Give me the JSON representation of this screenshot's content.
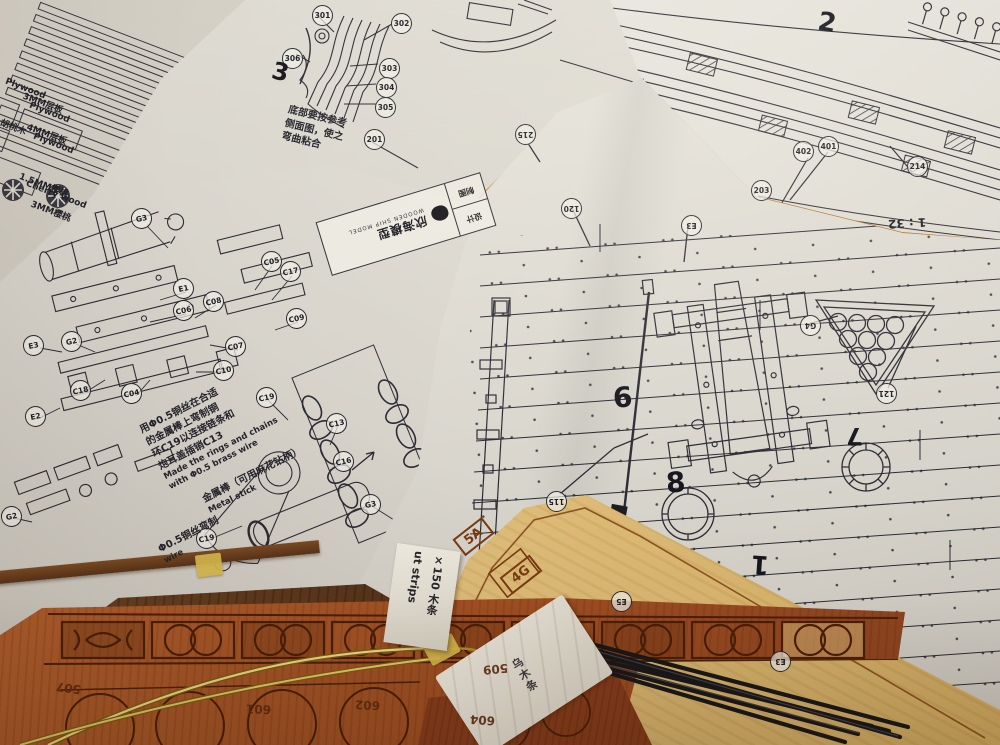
{
  "scene": {
    "scale_label": "1 : 32"
  },
  "title_block": {
    "brand": "欣海模型",
    "brand_sub": "WOODEN SHIP MODEL",
    "field_design": "设计",
    "field_draft": "制图"
  },
  "parts_sheet": {
    "labels": [
      {
        "t": "Plywood",
        "x": 4,
        "y": 84
      },
      {
        "t": "3MM层板",
        "x": 22,
        "y": 96
      },
      {
        "t": "Plywood",
        "x": 28,
        "y": 108
      },
      {
        "t": "胡桃木",
        "x": 0,
        "y": 120
      },
      {
        "t": "4MM层板",
        "x": 26,
        "y": 127
      },
      {
        "t": "Plywood",
        "x": 32,
        "y": 139
      },
      {
        "t": "1.5MM樱桃",
        "x": 18,
        "y": 178
      },
      {
        "t": "Cherry wood",
        "x": 24,
        "y": 190
      },
      {
        "t": "3MM樱桃",
        "x": 30,
        "y": 204
      }
    ]
  },
  "notes": {
    "stern_note": {
      "l1": "底部要按参考",
      "l2": "侧面图，使之",
      "l3": "弯曲粘合"
    },
    "chain_note": {
      "l1": "用Φ0.5铜丝在合适",
      "l2": "的金属棒上弯制铜",
      "l3": "环C19以连接链条和",
      "l4": "炮耳盖插销C13",
      "e1": "Made the rings and chains",
      "e2": "with Φ0.5 brass wire"
    },
    "stick_note": {
      "l1": "金属棒（可用麻花钻柄）",
      "l2": "Metal stick"
    },
    "wire_note": {
      "l1": "Φ0.5铜丝弯制",
      "l2": "wire"
    }
  },
  "tags": {
    "strip_tag": {
      "col1": "×150 木条",
      "col2": "ut strips"
    },
    "bundle_tag": {
      "line1": "乌木条"
    }
  },
  "callouts": {
    "sheet_b": [
      {
        "t": "301",
        "x": 312,
        "y": 5
      },
      {
        "t": "302",
        "x": 391,
        "y": 13
      },
      {
        "t": "306",
        "x": 282,
        "y": 48
      },
      {
        "t": "303",
        "x": 379,
        "y": 58
      },
      {
        "t": "304",
        "x": 376,
        "y": 77
      },
      {
        "t": "305",
        "x": 375,
        "y": 97
      },
      {
        "t": "201",
        "x": 364,
        "y": 129
      }
    ],
    "sheet_c": [
      {
        "t": "401",
        "x": 818,
        "y": 136
      },
      {
        "t": "402",
        "x": 793,
        "y": 141
      },
      {
        "t": "214",
        "x": 907,
        "y": 156
      },
      {
        "t": "203",
        "x": 751,
        "y": 180
      }
    ],
    "sheet_d": [
      {
        "t": "G3",
        "x": 131,
        "y": 208,
        "r": -12
      },
      {
        "t": "E1",
        "x": 173,
        "y": 278,
        "r": -12
      },
      {
        "t": "C06",
        "x": 173,
        "y": 300,
        "r": -12
      },
      {
        "t": "C08",
        "x": 203,
        "y": 291,
        "r": -12
      },
      {
        "t": "C05",
        "x": 261,
        "y": 251,
        "r": -12
      },
      {
        "t": "C17",
        "x": 280,
        "y": 261,
        "r": -12
      },
      {
        "t": "C09",
        "x": 286,
        "y": 308,
        "r": -12
      },
      {
        "t": "E3",
        "x": 23,
        "y": 335,
        "r": -12
      },
      {
        "t": "G2",
        "x": 61,
        "y": 331,
        "r": -12
      },
      {
        "t": "C18",
        "x": 70,
        "y": 380,
        "r": -12
      },
      {
        "t": "C07",
        "x": 225,
        "y": 336,
        "r": -12
      },
      {
        "t": "C10",
        "x": 213,
        "y": 360,
        "r": -12
      },
      {
        "t": "C04",
        "x": 121,
        "y": 383,
        "r": -12
      },
      {
        "t": "E2",
        "x": 25,
        "y": 406,
        "r": -12
      },
      {
        "t": "C19",
        "x": 256,
        "y": 387,
        "r": -12
      },
      {
        "t": "C13",
        "x": 326,
        "y": 413,
        "r": -12
      },
      {
        "t": "C16",
        "x": 333,
        "y": 451,
        "r": -12
      },
      {
        "t": "G3",
        "x": 360,
        "y": 494,
        "r": -12
      },
      {
        "t": "G2",
        "x": 1,
        "y": 506,
        "r": -12
      },
      {
        "t": "C19",
        "x": 196,
        "y": 528,
        "r": -12
      }
    ],
    "sheet_e": [
      {
        "t": "215",
        "x": 515,
        "y": 124,
        "r": 180
      },
      {
        "t": "120",
        "x": 561,
        "y": 198,
        "r": 180
      },
      {
        "t": "E3",
        "x": 681,
        "y": 215,
        "r": 180
      },
      {
        "t": "G4",
        "x": 800,
        "y": 315,
        "r": 180
      },
      {
        "t": "121",
        "x": 876,
        "y": 383,
        "r": 180
      },
      {
        "t": "115",
        "x": 546,
        "y": 491,
        "r": 180
      },
      {
        "t": "E5",
        "x": 611,
        "y": 591,
        "r": 180
      },
      {
        "t": "E3",
        "x": 770,
        "y": 651,
        "r": 180
      }
    ]
  },
  "numerals": [
    {
      "t": "3",
      "x": 272,
      "y": 58,
      "r": 14,
      "s": 24
    },
    {
      "t": "2",
      "x": 818,
      "y": 8,
      "r": 10,
      "s": 26
    },
    {
      "t": "6",
      "x": 613,
      "y": 381,
      "r": -4,
      "s": 28
    },
    {
      "t": "8",
      "x": 666,
      "y": 466,
      "r": -4,
      "s": 28
    },
    {
      "t": "7",
      "x": 846,
      "y": 422,
      "r": 180,
      "s": 24
    },
    {
      "t": "1",
      "x": 751,
      "y": 549,
      "r": 184,
      "s": 26
    }
  ],
  "wood_numbers": [
    {
      "t": "507",
      "x": 56,
      "y": 681,
      "r": 188
    },
    {
      "t": "509",
      "x": 483,
      "y": 662,
      "r": 175
    },
    {
      "t": "601",
      "x": 246,
      "y": 702,
      "r": 182
    },
    {
      "t": "602",
      "x": 355,
      "y": 698,
      "r": 183
    },
    {
      "t": "604",
      "x": 470,
      "y": 713,
      "r": 184
    }
  ],
  "sheet_marks": [
    {
      "t": "5A",
      "x": 455,
      "y": 526,
      "r": -38
    },
    {
      "t": "4G",
      "x": 502,
      "y": 564,
      "r": -38
    }
  ]
}
